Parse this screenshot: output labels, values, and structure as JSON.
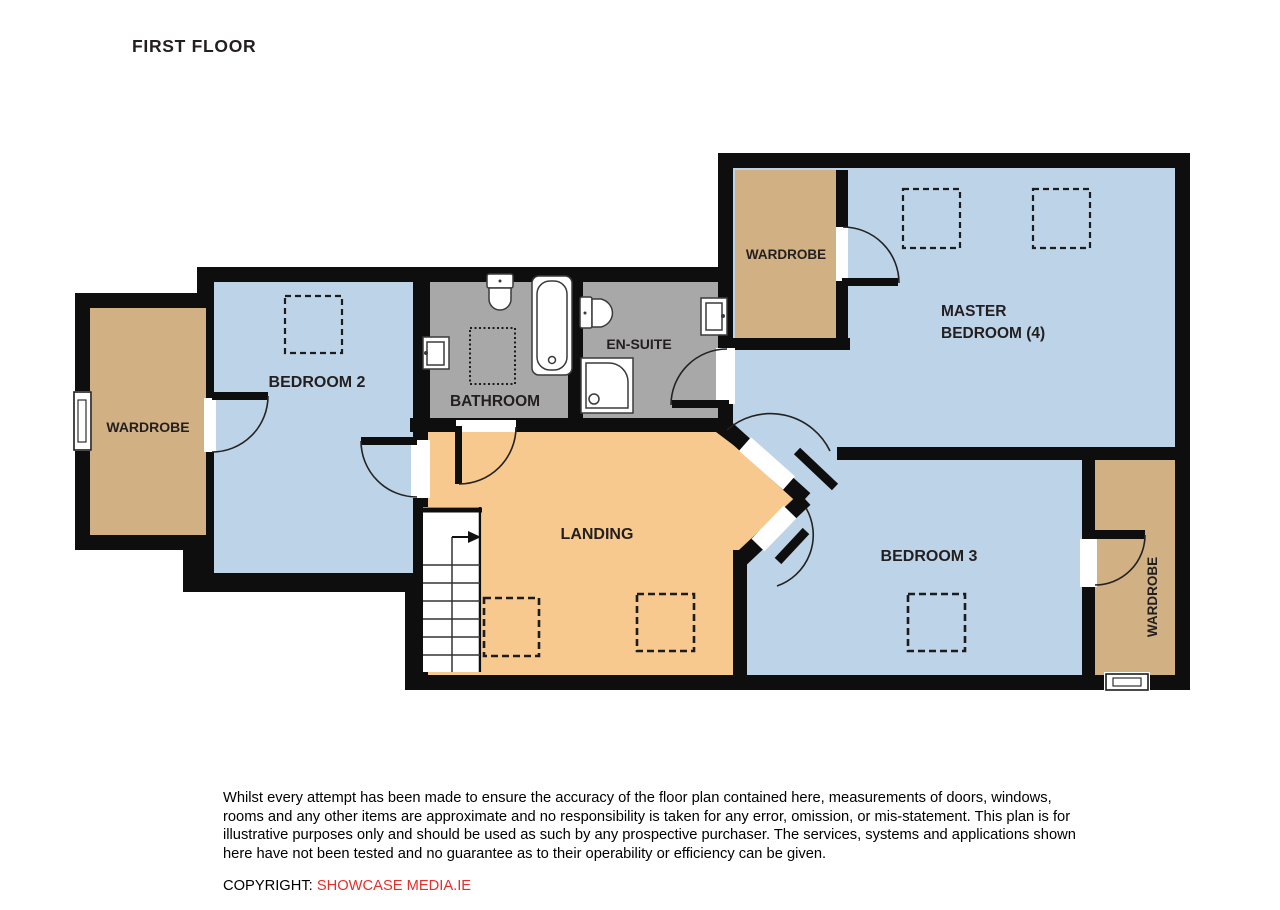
{
  "title": "FIRST FLOOR",
  "colors": {
    "room_blue": "#BDD3E7",
    "wardrobe_tan": "#D1B083",
    "landing_orange": "#F7C98E",
    "bathroom_gray": "#A8A8A8",
    "wall_black": "#0e0e0e",
    "copyright_red": "#e62e2a"
  },
  "rooms": {
    "wardrobe_left": {
      "label": "WARDROBE"
    },
    "bedroom2": {
      "label": "BEDROOM 2"
    },
    "bathroom": {
      "label": "BATHROOM"
    },
    "ensuite": {
      "label": "EN-SUITE"
    },
    "wardrobe_master": {
      "label": "WARDROBE"
    },
    "master_bedroom": {
      "label_line1": "MASTER",
      "label_line2": "BEDROOM (4)"
    },
    "landing": {
      "label": "LANDING"
    },
    "bedroom3": {
      "label": "BEDROOM 3"
    },
    "wardrobe_right": {
      "label": "WARDROBE"
    }
  },
  "symbols": [
    "toilet-icon",
    "bathtub-icon",
    "sink-icon",
    "shower-icon",
    "stairs",
    "door-arc",
    "window-icon",
    "skylight-dashed-square"
  ],
  "disclaimer": {
    "lines": [
      "Whilst every attempt has been made to ensure the accuracy of the floor plan contained here, measurements of doors, windows,",
      "rooms and any other items are approximate and no responsibility is taken for any error, omission, or mis-statement.  This plan is for",
      "illustrative purposes only and should be used as such by any prospective purchaser.  The services, systems and applications shown",
      "here have not been tested and no guarantee as to their operability or efficiency can be given."
    ]
  },
  "copyright": {
    "prefix": "COPYRIGHT: ",
    "company": "SHOWCASE MEDIA.IE"
  }
}
